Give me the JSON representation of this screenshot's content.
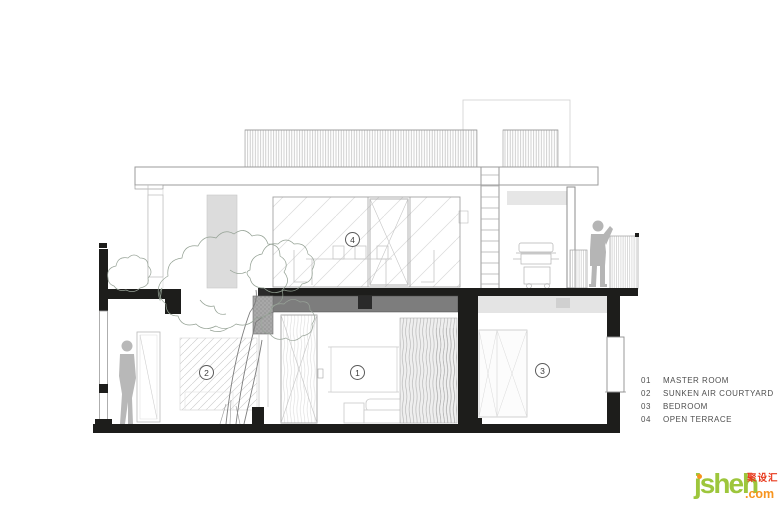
{
  "legend": {
    "items": [
      {
        "num": "01",
        "label": "MASTER ROOM"
      },
      {
        "num": "02",
        "label": "SUNKEN AIR COURTYARD"
      },
      {
        "num": "03",
        "label": "BEDROOM"
      },
      {
        "num": "04",
        "label": "OPEN TERRACE"
      }
    ]
  },
  "markers": [
    {
      "num": "1"
    },
    {
      "num": "2"
    },
    {
      "num": "3"
    },
    {
      "num": "4"
    }
  ],
  "logo": {
    "name": "jsheh",
    "tld": ".com",
    "cjk": "聚设汇"
  },
  "colors": {
    "ink": "#1d1d1b",
    "slab_gray": "#7d7d7d",
    "ceiling_gray": "#e4e4e4",
    "figure_gray": "#b5b5b5",
    "logo_green": "#9dc63c",
    "logo_orange": "#f7941d",
    "logo_red": "#e8391d"
  }
}
